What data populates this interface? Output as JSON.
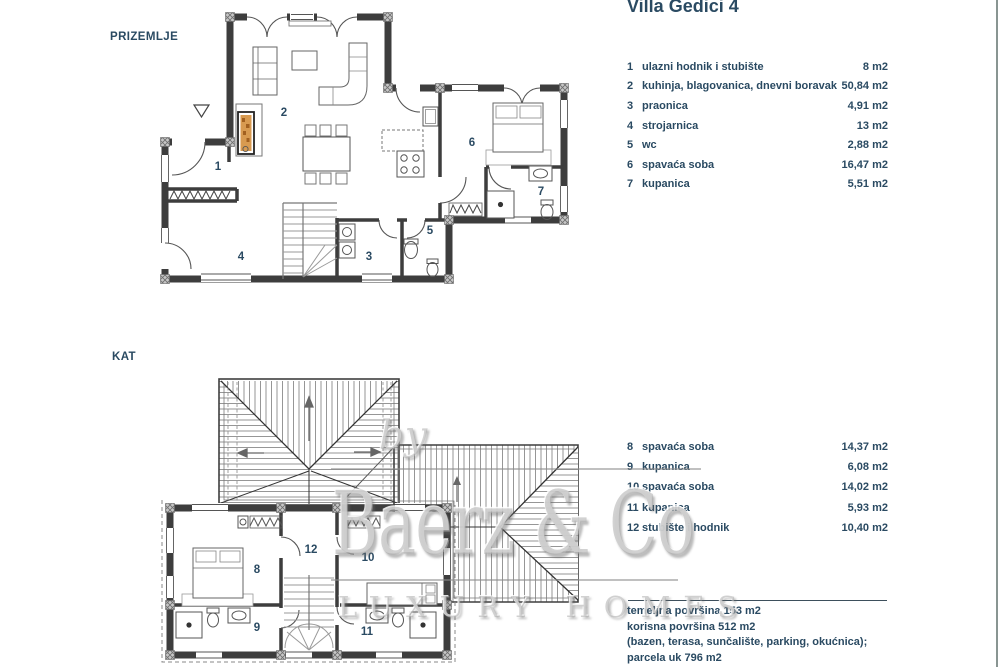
{
  "page": {
    "title": "Villa Gedici 4"
  },
  "floors": {
    "ground_label": "PRIZEMLJE",
    "upper_label": "KAT"
  },
  "plans": {
    "ground_rooms": [
      "1",
      "2",
      "3",
      "4",
      "5",
      "6",
      "7"
    ],
    "upper_rooms": [
      "8",
      "9",
      "10",
      "11",
      "12"
    ]
  },
  "legend_ground": {
    "items": [
      {
        "num": "1",
        "label": "ulazni hodnik i stubište",
        "area": "8 m2"
      },
      {
        "num": "2",
        "label": "kuhinja, blagovanica, dnevni boravak",
        "area": "50,84 m2"
      },
      {
        "num": "3",
        "label": "praonica",
        "area": "4,91 m2"
      },
      {
        "num": "4",
        "label": "strojarnica",
        "area": "13 m2"
      },
      {
        "num": "5",
        "label": "wc",
        "area": "2,88 m2"
      },
      {
        "num": "6",
        "label": "spavaća soba",
        "area": "16,47 m2"
      },
      {
        "num": "7",
        "label": "kupanica",
        "area": "5,51 m2"
      }
    ]
  },
  "legend_upper": {
    "items": [
      {
        "num": "8",
        "label": "spavaća soba",
        "area": "14,37 m2"
      },
      {
        "num": "9",
        "label": "kupanica",
        "area": "6,08 m2"
      },
      {
        "num": "10",
        "label": "spavaća soba",
        "area": "14,02 m2"
      },
      {
        "num": "11",
        "label": "kupanica",
        "area": "5,93 m2"
      },
      {
        "num": "12",
        "label": "stubište i hodnik",
        "area": "10,40 m2"
      }
    ]
  },
  "summary": {
    "line1": "temeljna površina 153 m2",
    "line2": "korisna površina 512 m2",
    "line3": "(bazen, terasa, sunčalište, parking, okućnica);",
    "line4": "parcela uk 796 m2"
  },
  "watermark": {
    "by": "by",
    "brand": "Baerz & Co",
    "tagline": "LUXURY HOMES"
  },
  "colors": {
    "text_navy": "#2a4a62",
    "wall_dark": "#3d3d3d",
    "fireplace_orange": "#d89a50",
    "watermark_gray": "#9a9a9a"
  }
}
